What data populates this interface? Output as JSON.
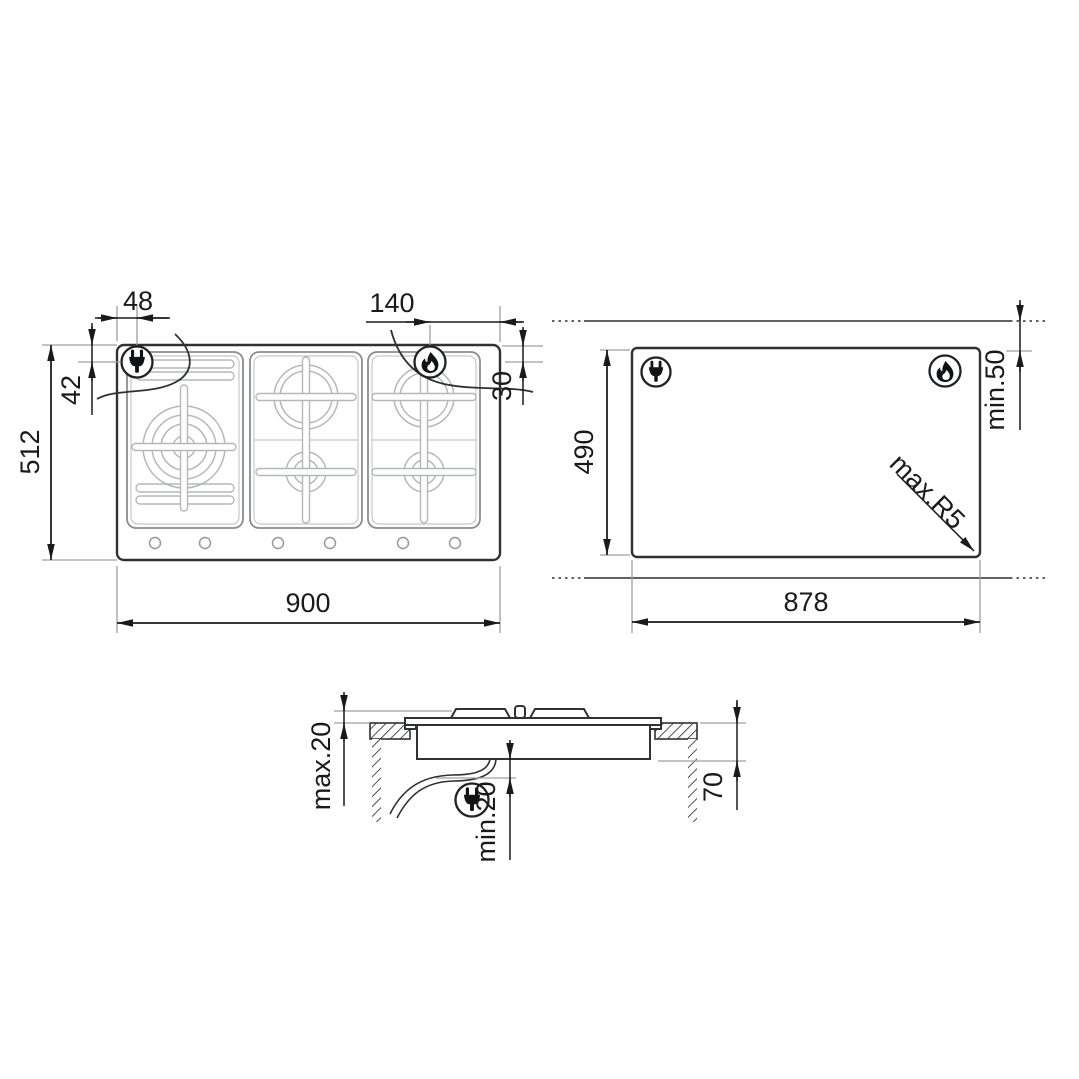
{
  "title": "gas-hob-installation-dimension-diagram",
  "colors": {
    "background": "#ffffff",
    "main_line": "#2f3133",
    "dimension_line": "#1a1a1a",
    "extension_line": "#9d9fa2",
    "burner_detail": "#b5b7b9"
  },
  "top_view": {
    "name": "hob-top-view",
    "width_label": "900",
    "depth_label": "512",
    "plug_offset_h_label": "48",
    "plug_offset_v_label": "42",
    "flame_offset_h_label": "140",
    "flame_offset_v_label": "30",
    "icons": [
      "power-plug-icon",
      "gas-flame-icon"
    ]
  },
  "cutout_view": {
    "name": "worktop-cutout-view",
    "width_label": "878",
    "depth_label": "490",
    "front_clearance_label": "min.50",
    "corner_radius_label": "max.R5",
    "icons": [
      "power-plug-icon",
      "gas-flame-icon"
    ]
  },
  "section_view": {
    "name": "side-section-view",
    "protrusion_label": "max.20",
    "clearance_label": "min.20",
    "recess_label": "70",
    "icons": [
      "power-plug-icon"
    ]
  }
}
